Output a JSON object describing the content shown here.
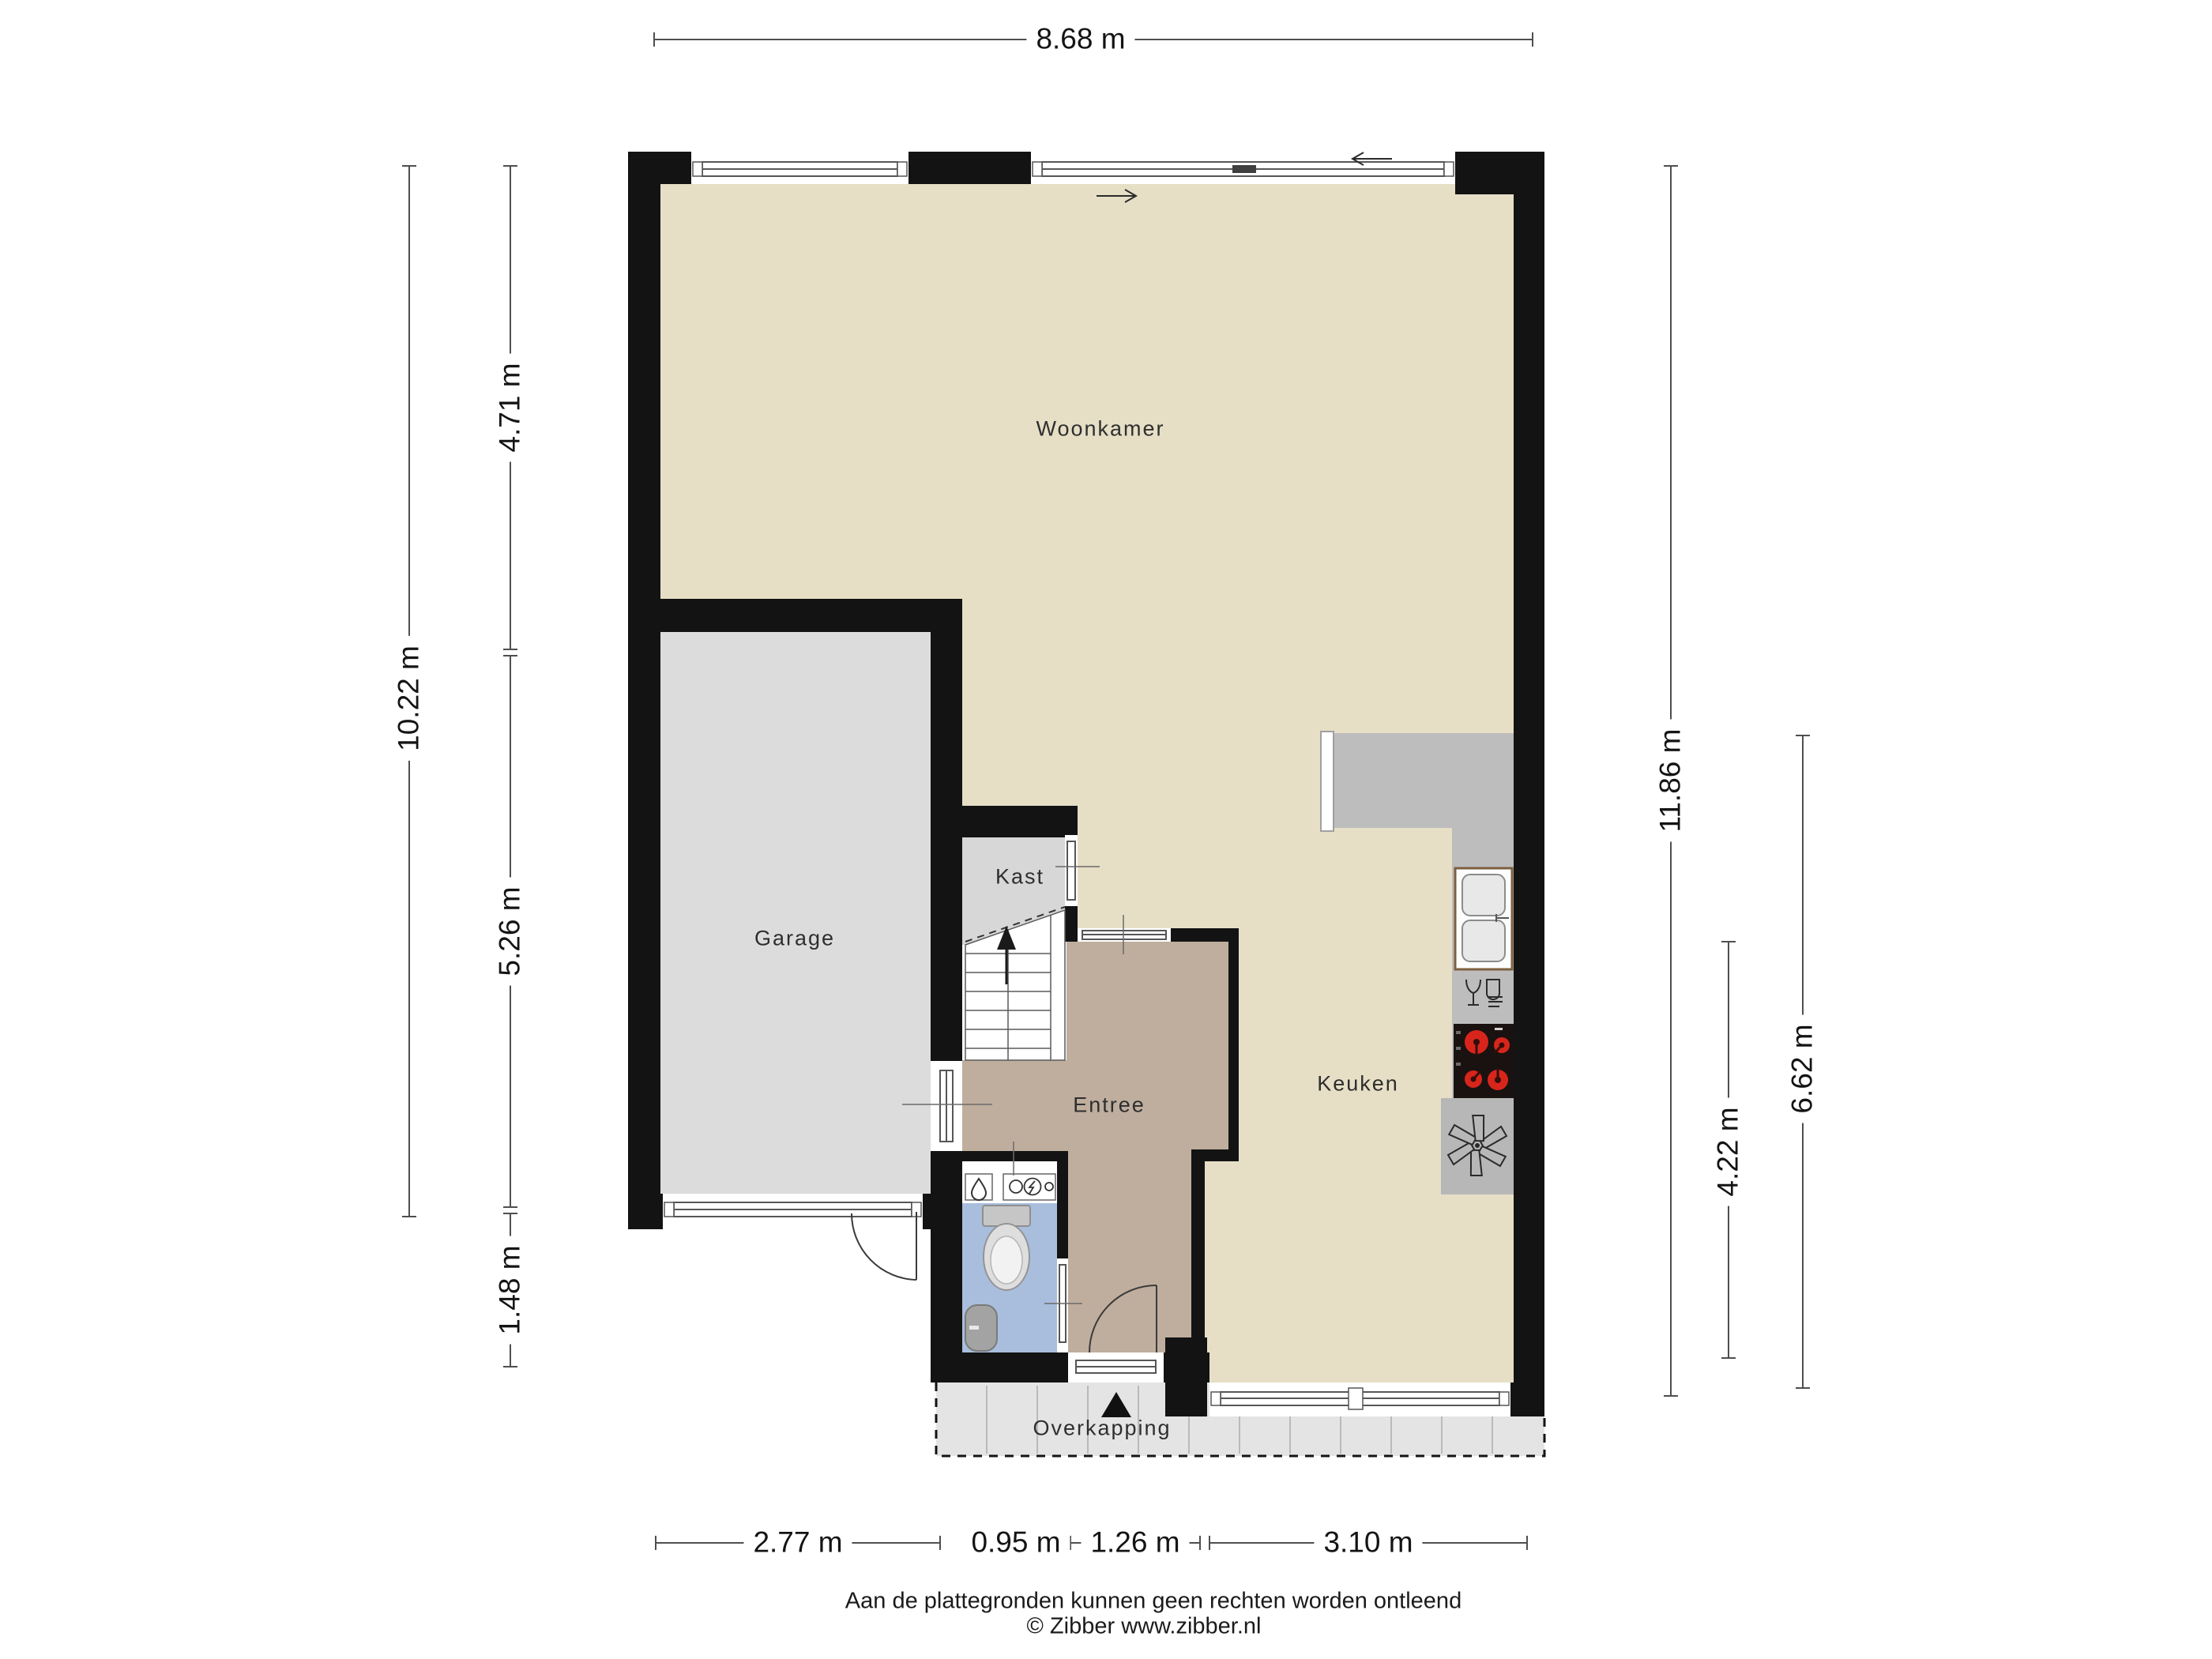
{
  "rooms": {
    "woonkamer": "Woonkamer",
    "garage": "Garage",
    "kast": "Kast",
    "entree": "Entree",
    "keuken": "Keuken",
    "overkapping": "Overkapping"
  },
  "dimensions": {
    "top_width": "8.68 m",
    "left_total_height": "10.22 m",
    "left_upper": "4.71 m",
    "left_middle": "5.26 m",
    "left_lower": "1.48 m",
    "right_total_height": "11.86 m",
    "right_kitchen": "6.62 m",
    "right_counter": "4.22 m",
    "bottom_garage": "2.77 m",
    "bottom_toilet": "0.95 m",
    "bottom_entree": "1.26 m",
    "bottom_kitchen": "3.10 m"
  },
  "footer": {
    "disclaimer": "Aan de plattegronden kunnen geen rechten worden ontleend",
    "credit": "© Zibber www.zibber.nl"
  },
  "colors": {
    "wall": "#131313",
    "floor_living": "#e6dfc6",
    "floor_entree": "#bfae9e",
    "floor_toilet": "#a9bedd",
    "floor_garage": "#dcdcdc",
    "floor_kast": "#d7d7d7",
    "floor_overkapping": "#e4e4e4",
    "counter": "#bdbdbd",
    "counter_dark": "#b7b7b7",
    "burner_red": "#d8251b"
  },
  "icons": {
    "stairs_arrow": "stairs-up-arrow",
    "entrance_marker": "entrance-triangle",
    "sliding_door_arrows": "sliding-direction-arrows",
    "appliances": [
      "double-sink",
      "dishwasher",
      "cooktop",
      "ventilation-fan"
    ],
    "sanitary": [
      "toilet",
      "fountain-sink",
      "water-drop",
      "electric-meter"
    ]
  }
}
